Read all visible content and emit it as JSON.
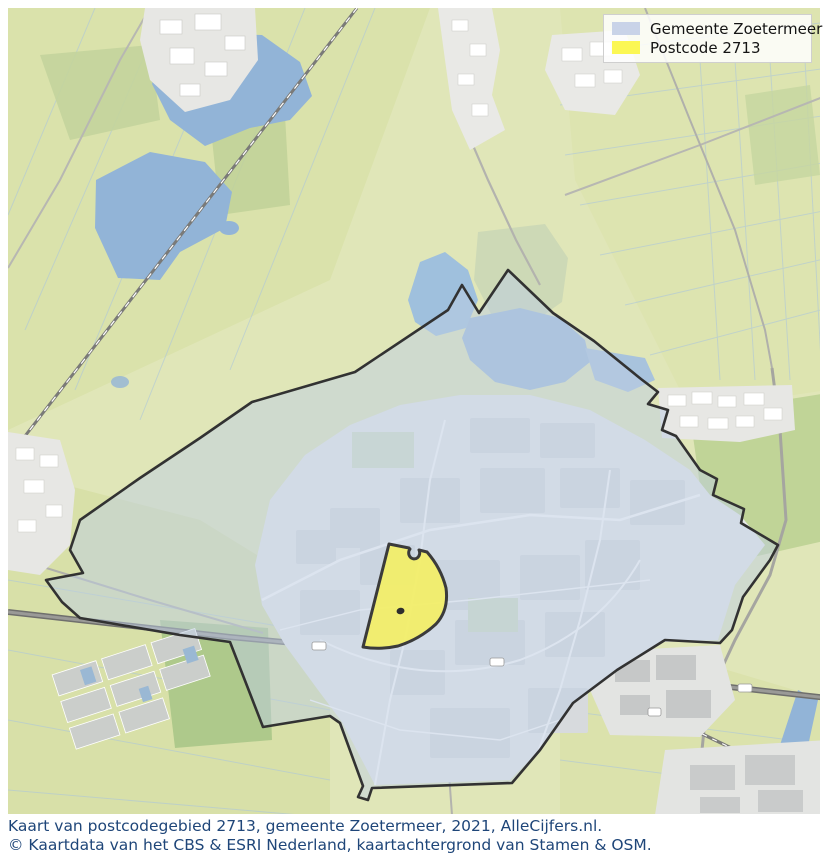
{
  "legend": {
    "items": [
      {
        "label": "Gemeente Zoetermeer",
        "color": "#c9d3e8"
      },
      {
        "label": "Postcode 2713",
        "color": "#fbf754"
      }
    ]
  },
  "caption": {
    "line1": "Kaart van postcodegebied 2713, gemeente Zoetermeer, 2021, AlleCijfers.nl.",
    "line2": "© Kaartdata van het CBS & ESRI Nederland, kaartachtergrond van Stamen & OSM."
  },
  "map": {
    "colors": {
      "gemeente_fill": "#becde4",
      "gemeente_stroke": "#323232",
      "postcode_fill": "#f3ef66",
      "postcode_stroke": "#3b3b3b",
      "water": "#92b4d7",
      "green_base": "#e0e6b8",
      "green_dark": "#b5cc90",
      "urban": "#e7e9ea",
      "road": "#a8a8a4",
      "railway": "#7a7a78",
      "caption_text": "#1f4679"
    }
  }
}
